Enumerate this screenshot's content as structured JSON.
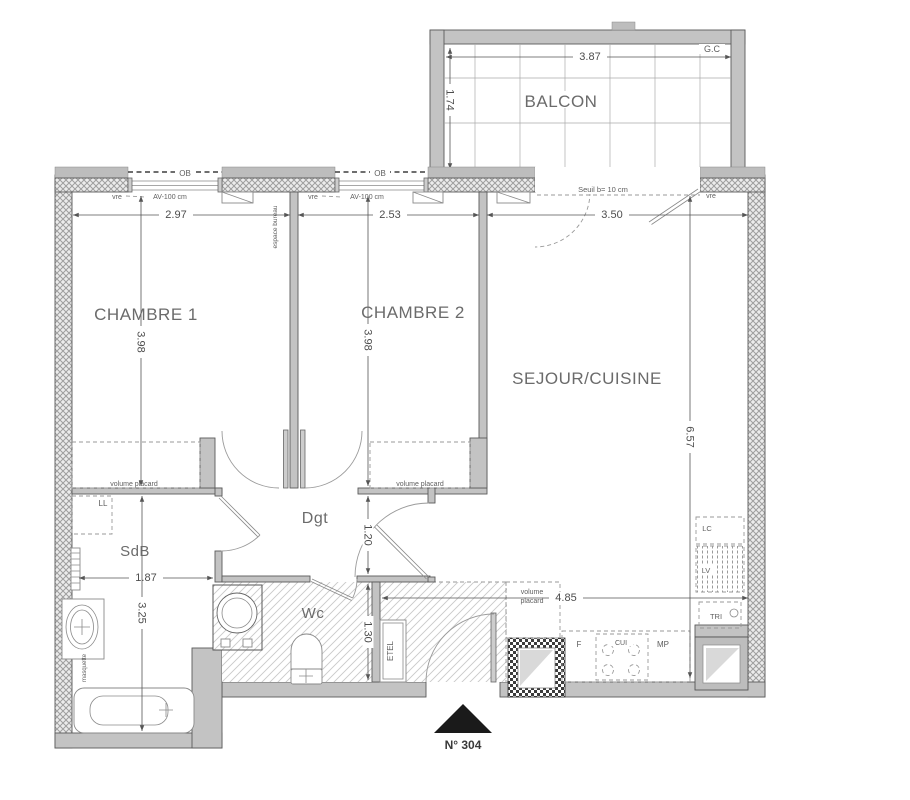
{
  "colors": {
    "wall": "#c3c3c3",
    "entry_marker": "#1a1a1a",
    "text": "#5f5f5f"
  },
  "balcony": {
    "label": "BALCON",
    "corner": "G.C",
    "width": "3.87",
    "depth": "1.74"
  },
  "rooms": {
    "chambre1": {
      "label": "CHAMBRE 1",
      "width": "2.97",
      "height": "3.98"
    },
    "chambre2": {
      "label": "CHAMBRE 2",
      "width": "2.53",
      "height": "3.98"
    },
    "sejour": {
      "label": "SEJOUR/CUISINE",
      "top_width": "3.50",
      "height": "6.57",
      "kitchen_width": "4.85"
    },
    "sdb": {
      "label": "SdB",
      "width": "1.87",
      "height": "3.25"
    },
    "dgt": {
      "label": "Dgt",
      "width": "1.20"
    },
    "wc": {
      "label": "Wc",
      "height": "1.30"
    }
  },
  "annotations": {
    "ob": "OB",
    "vre": "vre",
    "av": "AV-100 cm",
    "espace_bureau": "espace bureau",
    "seuil": "Seuil b= 10 cm",
    "masquette": "masquette",
    "etel": "ETEL",
    "ll": "LL",
    "volume_placard": "volume placard",
    "volume": "volume",
    "placard": "placard"
  },
  "kitchen": {
    "f": "F",
    "cui": "CUI",
    "mp": "MP",
    "lc": "LC",
    "lv": "LV",
    "tri": "TRI"
  },
  "entrance": {
    "unit": "N° 304"
  }
}
